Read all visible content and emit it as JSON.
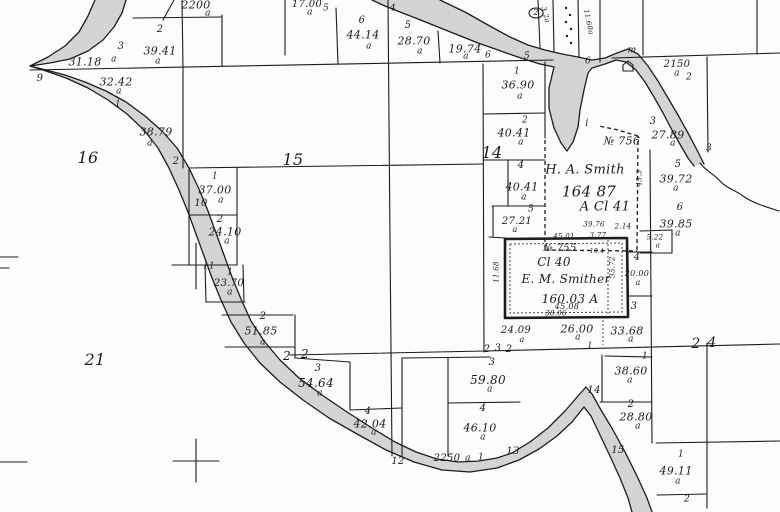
{
  "map": {
    "type": "cadastral-survey-plat",
    "colors": {
      "paper": "#fcfcfa",
      "ink": "#1c1c1c",
      "water": "#c9c9c9"
    },
    "claims": [
      {
        "survey_no": "№ 756",
        "owner": "H. A. Smith",
        "claim": "A Cl 41",
        "area": "164 87"
      },
      {
        "survey_no": "№ 755",
        "owner": "E. M. Smither",
        "claim": "Cl 40",
        "area": "160.03 A"
      }
    ],
    "section_numbers": [
      "16",
      "15",
      "14",
      "21",
      "22",
      "23",
      "24"
    ],
    "labels": [
      {
        "t": "2200",
        "x": 196,
        "y": 5,
        "s": 11
      },
      {
        "t": "a",
        "x": 208,
        "y": 14,
        "s": 9
      },
      {
        "t": "17.00",
        "x": 307,
        "y": 5,
        "s": 10
      },
      {
        "t": "a",
        "x": 310,
        "y": 13,
        "s": 9
      },
      {
        "t": "5",
        "x": 326,
        "y": 9,
        "s": 9
      },
      {
        "t": "2",
        "x": 160,
        "y": 30,
        "s": 10
      },
      {
        "t": "3",
        "x": 121,
        "y": 47,
        "s": 10
      },
      {
        "t": "39.41",
        "x": 160,
        "y": 51,
        "s": 11
      },
      {
        "t": "a",
        "x": 158,
        "y": 62,
        "s": 9
      },
      {
        "t": "31.18",
        "x": 85,
        "y": 62,
        "s": 11
      },
      {
        "t": "a",
        "x": 114,
        "y": 60,
        "s": 9
      },
      {
        "t": "9",
        "x": 40,
        "y": 79,
        "s": 10
      },
      {
        "t": "32.42",
        "x": 116,
        "y": 82,
        "s": 11
      },
      {
        "t": "a",
        "x": 119,
        "y": 92,
        "s": 9
      },
      {
        "t": "1",
        "x": 118,
        "y": 105,
        "s": 9
      },
      {
        "t": "38.79",
        "x": 156,
        "y": 132,
        "s": 11
      },
      {
        "t": "a",
        "x": 150,
        "y": 144,
        "s": 9
      },
      {
        "t": "2",
        "x": 176,
        "y": 162,
        "s": 10
      },
      {
        "t": "16",
        "x": 88,
        "y": 158,
        "s": 16
      },
      {
        "t": "6",
        "x": 362,
        "y": 21,
        "s": 10
      },
      {
        "t": "44.14",
        "x": 363,
        "y": 35,
        "s": 11
      },
      {
        "t": "a",
        "x": 369,
        "y": 47,
        "s": 9
      },
      {
        "t": "4",
        "x": 393,
        "y": 9,
        "s": 9
      },
      {
        "t": "5",
        "x": 408,
        "y": 26,
        "s": 10
      },
      {
        "t": "28.70",
        "x": 414,
        "y": 41,
        "s": 11
      },
      {
        "t": "a",
        "x": 420,
        "y": 52,
        "s": 9
      },
      {
        "t": "19.74",
        "x": 465,
        "y": 49,
        "s": 11
      },
      {
        "t": "a",
        "x": 466,
        "y": 57,
        "s": 9
      },
      {
        "t": "6",
        "x": 488,
        "y": 56,
        "s": 9
      },
      {
        "t": "15",
        "x": 293,
        "y": 160,
        "s": 16
      },
      {
        "t": "2",
        "x": 536,
        "y": 13,
        "s": 8
      },
      {
        "t": "3.2a",
        "x": 545,
        "y": 15,
        "s": 7,
        "r": 75
      },
      {
        "t": "11.60a",
        "x": 588,
        "y": 22,
        "s": 7,
        "r": 78
      },
      {
        "t": "5",
        "x": 527,
        "y": 57,
        "s": 9
      },
      {
        "t": "6",
        "x": 588,
        "y": 62,
        "s": 9
      },
      {
        "t": "m",
        "x": 632,
        "y": 51,
        "s": 9
      },
      {
        "t": "2150",
        "x": 677,
        "y": 65,
        "s": 10
      },
      {
        "t": "a",
        "x": 677,
        "y": 74,
        "s": 9
      },
      {
        "t": "2",
        "x": 689,
        "y": 78,
        "s": 9
      },
      {
        "t": "1",
        "x": 517,
        "y": 72,
        "s": 9
      },
      {
        "t": "36.90",
        "x": 518,
        "y": 85,
        "s": 11
      },
      {
        "t": "a",
        "x": 520,
        "y": 97,
        "s": 9
      },
      {
        "t": "2",
        "x": 525,
        "y": 121,
        "s": 9
      },
      {
        "t": "40.41",
        "x": 514,
        "y": 133,
        "s": 11
      },
      {
        "t": "a",
        "x": 521,
        "y": 143,
        "s": 9
      },
      {
        "t": "14",
        "x": 492,
        "y": 153,
        "s": 16
      },
      {
        "t": "4",
        "x": 521,
        "y": 166,
        "s": 10
      },
      {
        "t": "40.41",
        "x": 522,
        "y": 187,
        "s": 11
      },
      {
        "t": "a",
        "x": 524,
        "y": 198,
        "s": 9
      },
      {
        "t": "5",
        "x": 531,
        "y": 210,
        "s": 9
      },
      {
        "t": "27.21",
        "x": 517,
        "y": 222,
        "s": 10
      },
      {
        "t": "a",
        "x": 515,
        "y": 230,
        "s": 8
      },
      {
        "t": "i",
        "x": 587,
        "y": 124,
        "s": 10
      },
      {
        "t": "№ 756",
        "x": 622,
        "y": 141,
        "s": 11
      },
      {
        "t": "H. A. Smith",
        "x": 585,
        "y": 170,
        "s": 13
      },
      {
        "t": "164 87",
        "x": 589,
        "y": 192,
        "s": 15
      },
      {
        "t": "A Cl 41",
        "x": 605,
        "y": 207,
        "s": 13
      },
      {
        "t": "3",
        "x": 653,
        "y": 122,
        "s": 10
      },
      {
        "t": "27.89",
        "x": 668,
        "y": 135,
        "s": 11
      },
      {
        "t": "a",
        "x": 673,
        "y": 144,
        "s": 9
      },
      {
        "t": "3",
        "x": 709,
        "y": 149,
        "s": 9
      },
      {
        "t": "5",
        "x": 678,
        "y": 165,
        "s": 10
      },
      {
        "t": "39.72",
        "x": 676,
        "y": 179,
        "s": 11
      },
      {
        "t": "a",
        "x": 676,
        "y": 189,
        "s": 9
      },
      {
        "t": "6",
        "x": 680,
        "y": 208,
        "s": 10
      },
      {
        "t": "39.85",
        "x": 676,
        "y": 224,
        "s": 11
      },
      {
        "t": "a",
        "x": 678,
        "y": 234,
        "s": 9
      },
      {
        "t": "39.76",
        "x": 594,
        "y": 225,
        "s": 7
      },
      {
        "t": "2.14",
        "x": 623,
        "y": 227,
        "s": 7
      },
      {
        "t": "45.01",
        "x": 564,
        "y": 237,
        "s": 7
      },
      {
        "t": "3.77",
        "x": 598,
        "y": 236,
        "s": 7
      },
      {
        "t": "5.22",
        "x": 655,
        "y": 238,
        "s": 7
      },
      {
        "t": "a",
        "x": 658,
        "y": 246,
        "s": 7
      },
      {
        "t": "№ 755",
        "x": 560,
        "y": 249,
        "s": 10
      },
      {
        "t": "10.4",
        "x": 597,
        "y": 252,
        "s": 6
      },
      {
        "t": "Cl 40",
        "x": 554,
        "y": 262,
        "s": 12
      },
      {
        "t": "E. M. Smither",
        "x": 566,
        "y": 279,
        "s": 12
      },
      {
        "t": "160.03 A",
        "x": 570,
        "y": 299,
        "s": 12
      },
      {
        "t": "45.08",
        "x": 567,
        "y": 307,
        "s": 8
      },
      {
        "t": "38.06",
        "x": 556,
        "y": 314,
        "s": 7
      },
      {
        "t": "11.68",
        "x": 497,
        "y": 272,
        "s": 7,
        "r": -90
      },
      {
        "t": "35.72",
        "x": 613,
        "y": 267,
        "s": 7,
        "r": -90
      },
      {
        "t": "45.3",
        "x": 640,
        "y": 178,
        "s": 7,
        "r": -90
      },
      {
        "t": "4",
        "x": 637,
        "y": 258,
        "s": 10
      },
      {
        "t": "20.00",
        "x": 637,
        "y": 274,
        "s": 8
      },
      {
        "t": "a",
        "x": 638,
        "y": 283,
        "s": 8
      },
      {
        "t": "3",
        "x": 634,
        "y": 307,
        "s": 10
      },
      {
        "t": "37.00",
        "x": 215,
        "y": 190,
        "s": 11
      },
      {
        "t": "a",
        "x": 221,
        "y": 201,
        "s": 9
      },
      {
        "t": "1",
        "x": 215,
        "y": 177,
        "s": 9
      },
      {
        "t": "10",
        "x": 201,
        "y": 204,
        "s": 10
      },
      {
        "t": "2",
        "x": 220,
        "y": 220,
        "s": 10
      },
      {
        "t": "24.10",
        "x": 225,
        "y": 232,
        "s": 11
      },
      {
        "t": "a",
        "x": 227,
        "y": 242,
        "s": 9
      },
      {
        "t": "11",
        "x": 209,
        "y": 267,
        "s": 9
      },
      {
        "t": "1",
        "x": 230,
        "y": 273,
        "s": 9
      },
      {
        "t": "23.70",
        "x": 229,
        "y": 284,
        "s": 10
      },
      {
        "t": "a",
        "x": 230,
        "y": 293,
        "s": 9
      },
      {
        "t": "2",
        "x": 263,
        "y": 317,
        "s": 10
      },
      {
        "t": "51.85",
        "x": 261,
        "y": 331,
        "s": 11
      },
      {
        "t": "a",
        "x": 263,
        "y": 343,
        "s": 9
      },
      {
        "t": "21",
        "x": 95,
        "y": 360,
        "s": 16
      },
      {
        "t": "2",
        "x": 287,
        "y": 356,
        "s": 12
      },
      {
        "t": "2",
        "x": 305,
        "y": 354,
        "s": 12
      },
      {
        "t": "3",
        "x": 318,
        "y": 369,
        "s": 10
      },
      {
        "t": "54.64",
        "x": 316,
        "y": 383,
        "s": 12
      },
      {
        "t": "a",
        "x": 320,
        "y": 394,
        "s": 9
      },
      {
        "t": "4",
        "x": 368,
        "y": 412,
        "s": 10
      },
      {
        "t": "42.04",
        "x": 370,
        "y": 424,
        "s": 11
      },
      {
        "t": "a",
        "x": 374,
        "y": 433,
        "s": 9
      },
      {
        "t": "12",
        "x": 398,
        "y": 462,
        "s": 10
      },
      {
        "t": "2250",
        "x": 447,
        "y": 459,
        "s": 10
      },
      {
        "t": "a",
        "x": 468,
        "y": 459,
        "s": 9
      },
      {
        "t": "1",
        "x": 481,
        "y": 458,
        "s": 9
      },
      {
        "t": "13",
        "x": 513,
        "y": 452,
        "s": 10
      },
      {
        "t": "3",
        "x": 492,
        "y": 363,
        "s": 10
      },
      {
        "t": "59.80",
        "x": 488,
        "y": 380,
        "s": 12
      },
      {
        "t": "a",
        "x": 490,
        "y": 390,
        "s": 9
      },
      {
        "t": "4",
        "x": 483,
        "y": 409,
        "s": 10
      },
      {
        "t": "46.10",
        "x": 480,
        "y": 428,
        "s": 11
      },
      {
        "t": "a",
        "x": 483,
        "y": 438,
        "s": 9
      },
      {
        "t": "24.09",
        "x": 516,
        "y": 331,
        "s": 10
      },
      {
        "t": "a",
        "x": 522,
        "y": 340,
        "s": 8
      },
      {
        "t": "2",
        "x": 487,
        "y": 350,
        "s": 10
      },
      {
        "t": "3",
        "x": 498,
        "y": 349,
        "s": 10
      },
      {
        "t": "2",
        "x": 509,
        "y": 350,
        "s": 10
      },
      {
        "t": "26.00",
        "x": 577,
        "y": 329,
        "s": 11
      },
      {
        "t": "a",
        "x": 578,
        "y": 338,
        "s": 9
      },
      {
        "t": "1",
        "x": 590,
        "y": 346,
        "s": 8
      },
      {
        "t": "33.68",
        "x": 627,
        "y": 331,
        "s": 11
      },
      {
        "t": "a",
        "x": 631,
        "y": 340,
        "s": 9
      },
      {
        "t": "2",
        "x": 696,
        "y": 344,
        "s": 14
      },
      {
        "t": "4",
        "x": 712,
        "y": 343,
        "s": 14
      },
      {
        "t": "1",
        "x": 645,
        "y": 357,
        "s": 9
      },
      {
        "t": "38.60",
        "x": 631,
        "y": 371,
        "s": 11
      },
      {
        "t": "a",
        "x": 630,
        "y": 381,
        "s": 9
      },
      {
        "t": "14",
        "x": 594,
        "y": 391,
        "s": 10
      },
      {
        "t": "2",
        "x": 631,
        "y": 405,
        "s": 10
      },
      {
        "t": "28.80",
        "x": 636,
        "y": 417,
        "s": 11
      },
      {
        "t": "a",
        "x": 638,
        "y": 427,
        "s": 9
      },
      {
        "t": "15",
        "x": 618,
        "y": 451,
        "s": 10
      },
      {
        "t": "1",
        "x": 681,
        "y": 455,
        "s": 9
      },
      {
        "t": "49.11",
        "x": 676,
        "y": 471,
        "s": 11
      },
      {
        "t": "a",
        "x": 678,
        "y": 482,
        "s": 9
      },
      {
        "t": "2",
        "x": 687,
        "y": 500,
        "s": 9
      }
    ]
  }
}
